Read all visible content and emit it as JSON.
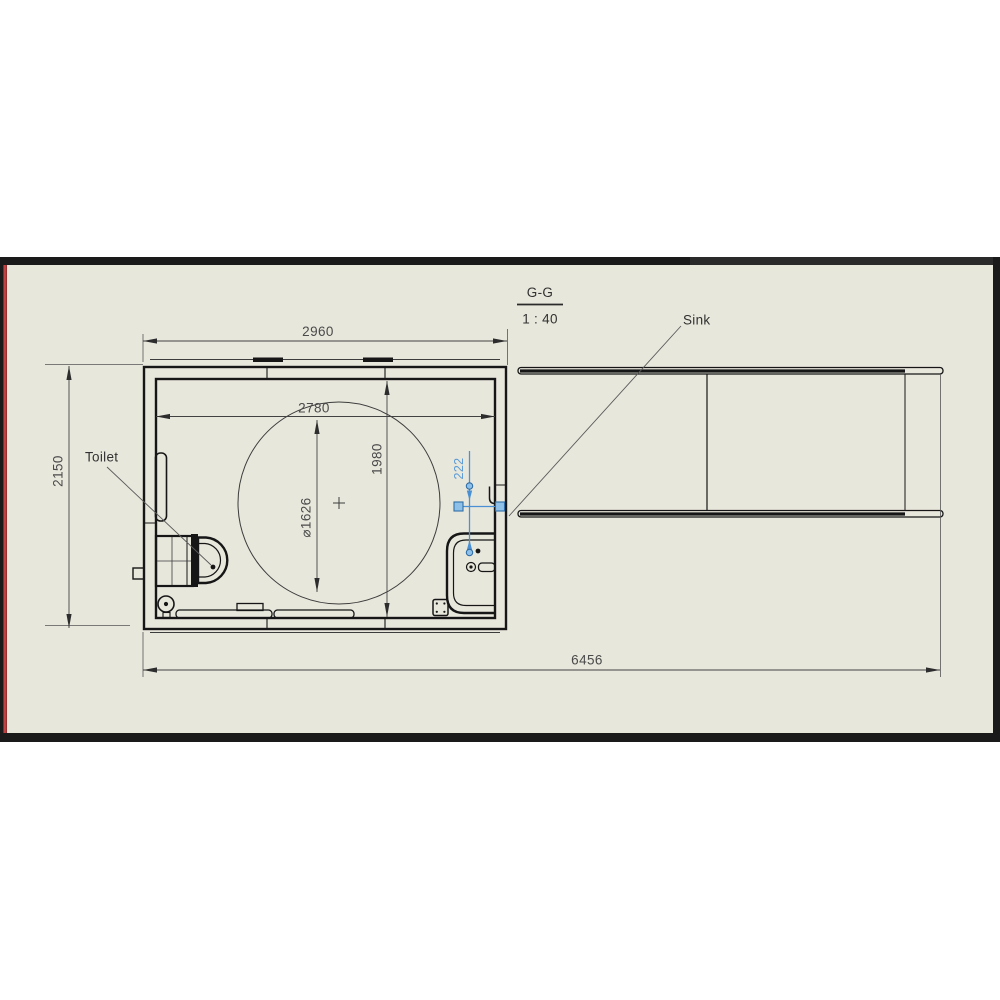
{
  "canvas": {
    "background_color": "#e8e7dc",
    "frame_color": "#1a1a1a",
    "left_edge_accent_color": "#c43f3f",
    "drawing_line_color": "#161616",
    "selection_color": "#4a90d2"
  },
  "view": {
    "section_label": "G-G",
    "scale_label": "1 : 40"
  },
  "callouts": {
    "toilet": "Toilet",
    "sink": "Sink"
  },
  "dimensions": {
    "overall_width": "2960",
    "inner_width": "2780",
    "inner_depth": "1980",
    "overall_depth": "2150",
    "circle_diameter": "⌀1626",
    "sink_offset_selected": "222",
    "overall_length": "6456"
  }
}
